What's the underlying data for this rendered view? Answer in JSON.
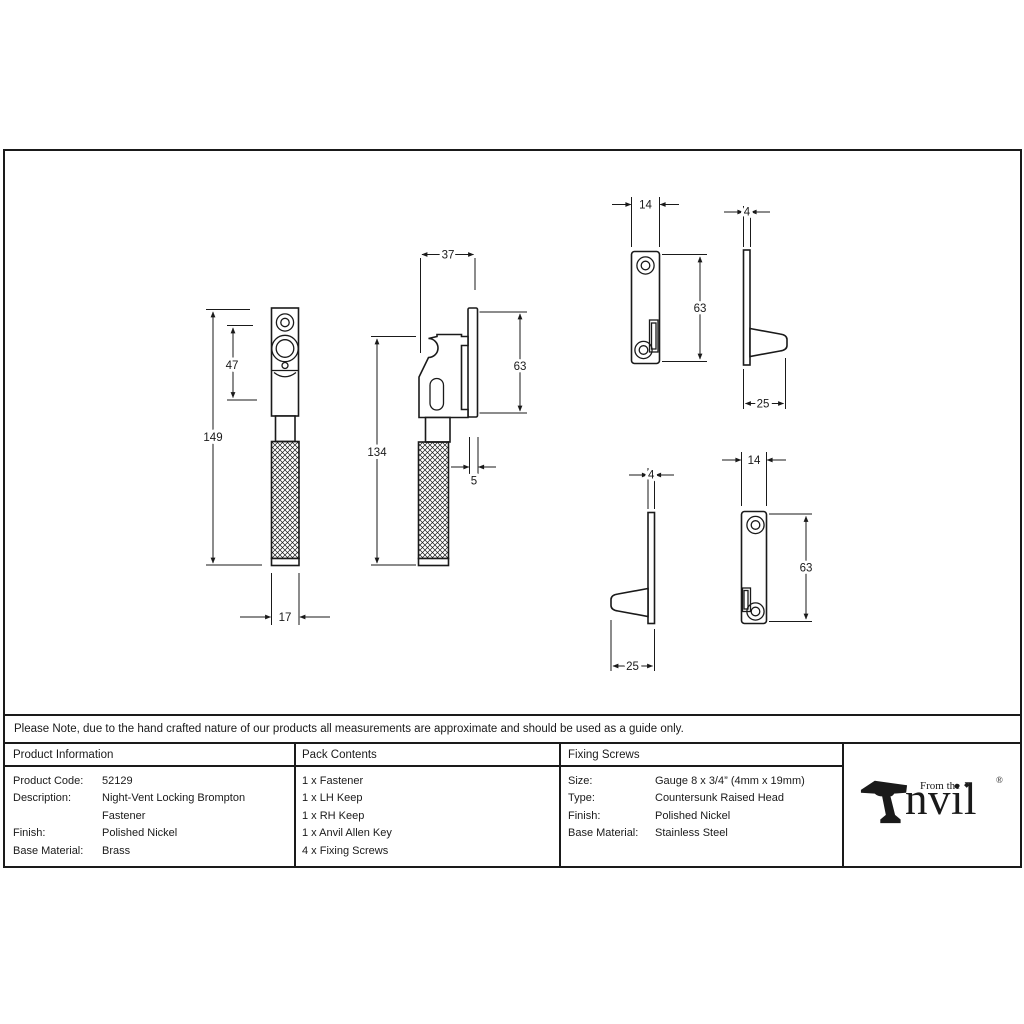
{
  "note": "Please Note, due to the hand crafted nature of our products all measurements are approximate and should be used as a guide only.",
  "table": {
    "product_information": {
      "header": "Product Information",
      "rows": [
        {
          "label": "Product Code:",
          "value": "52129"
        },
        {
          "label": "Description:",
          "value": "Night-Vent Locking Brompton Fastener"
        },
        {
          "label": "Finish:",
          "value": "Polished Nickel"
        },
        {
          "label": "Base Material:",
          "value": "Brass"
        }
      ]
    },
    "pack_contents": {
      "header": "Pack Contents",
      "items": [
        "1 x Fastener",
        "1 x LH Keep",
        "1 x RH Keep",
        "1 x Anvil Allen Key",
        "4 x Fixing Screws"
      ]
    },
    "fixing_screws": {
      "header": "Fixing Screws",
      "rows": [
        {
          "label": "Size:",
          "value": "Gauge 8 x 3/4” (4mm x 19mm)"
        },
        {
          "label": "Type:",
          "value": "Countersunk Raised Head"
        },
        {
          "label": "Finish:",
          "value": "Polished Nickel"
        },
        {
          "label": "Base Material:",
          "value": "Stainless Steel"
        }
      ]
    }
  },
  "logo": {
    "prefix": "From the",
    "diamond": "◆",
    "brand": "nvil",
    "registered": "®"
  },
  "dimensions": {
    "fastener_front": {
      "total_height": "149",
      "head_height": "47",
      "width": "17"
    },
    "fastener_side": {
      "plate_width": "37",
      "plate_height": "63",
      "handle_height": "134",
      "plate_thickness": "5"
    },
    "keep_top_front": {
      "width": "14",
      "height": "63"
    },
    "keep_top_side": {
      "thickness": "4",
      "depth": "25"
    },
    "keep_bottom_side": {
      "thickness": "4",
      "depth": "25"
    },
    "keep_bottom_front": {
      "width": "14",
      "height": "63"
    }
  },
  "colors": {
    "line": "#1a1a1a",
    "background": "#ffffff"
  }
}
